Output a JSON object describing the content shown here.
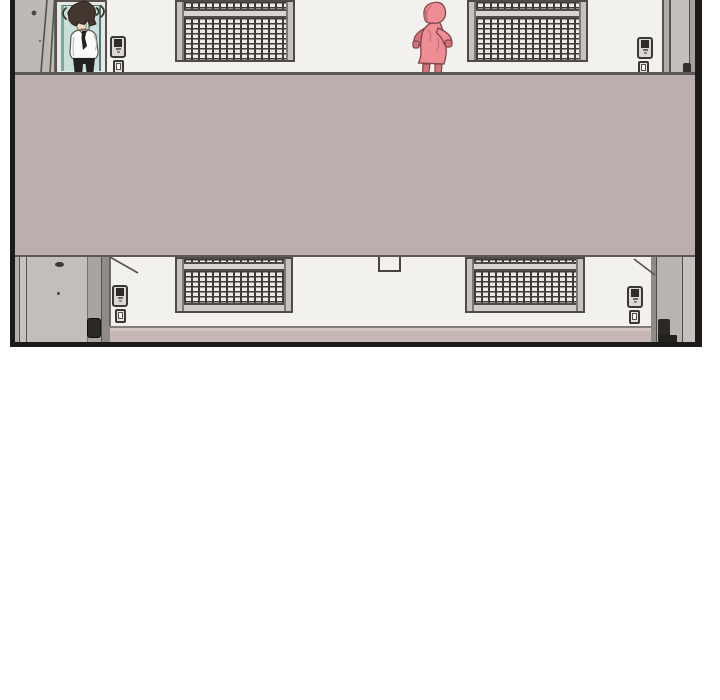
{
  "meta": {
    "kind": "webtoon-comic-panel",
    "description": "Exterior of a two-story apartment block seen across open-air walkways; a man in a white shirt and tie stands at an open door on the upper floor while a figure in a pink hooded jacket runs along the walkway; the lower floor with a closed door and barred windows is partly hidden behind the walkway slab; no text appears in the panel."
  },
  "colors": {
    "page_bg": "#ffffff",
    "ink": "#1d1b1a",
    "wall": "#f3f1ee",
    "walkway": "#bcaeac",
    "walkway_edge": "#5e5955",
    "bottom_strip": "#c6b7b5",
    "pillar": "#bdbab6",
    "door_gray": "#c2bfbb",
    "door_gray_dark": "#8f8c88",
    "frame_dark": "#4e4b48",
    "frame_light": "#c6c3bf",
    "grille_bar": "#3e3b38",
    "grille_cell": "#eceae7",
    "doorway_teal": "#c9e0da",
    "doorway_teal_dark": "#79a6a1",
    "device_body": "#dcd9d5",
    "device_screen": "#2f2d2b",
    "hair": "#44372f",
    "skin": "#eed8c4",
    "shirt": "#fcfbf9",
    "tie_pants": "#232120",
    "runner_pink": "#ef8d95",
    "runner_pink_dark": "#d4737c",
    "runner_outline": "#7d454c"
  },
  "panel": {
    "floors": [
      {
        "name": "upper",
        "barred_windows": 2,
        "open_doors": 1,
        "intercom_panels": 2,
        "outlets": 2
      },
      {
        "name": "lower",
        "barred_windows": 2,
        "closed_doors": 2,
        "intercom_panels": 2,
        "outlets": 2
      }
    ],
    "characters": [
      {
        "name": "standing-man",
        "outfit": "white shirt, dark tie, dark trousers",
        "pose": "standing in open doorway, head turning"
      },
      {
        "name": "running-figure",
        "outfit": "pink hooded jacket",
        "pose": "running left along walkway"
      }
    ]
  }
}
